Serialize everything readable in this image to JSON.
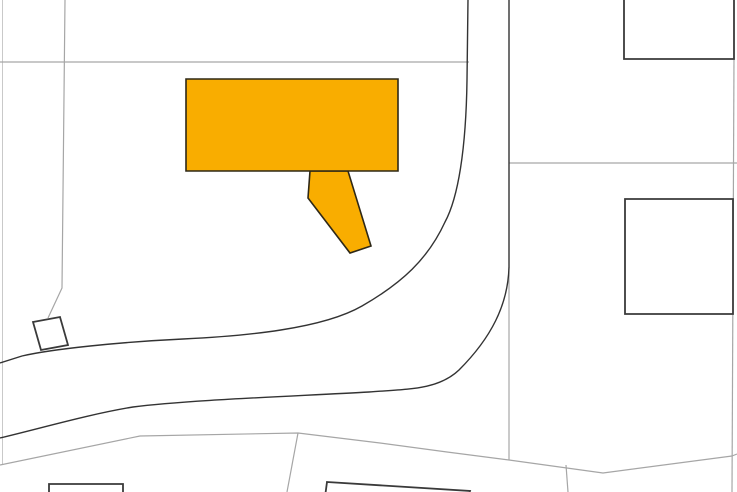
{
  "map": {
    "canvas": {
      "width": 737,
      "height": 492,
      "background": "#ffffff"
    },
    "colors": {
      "highlight_fill": "#F9AD00",
      "highlight_stroke": "#2E2817",
      "building_fill": "#FFFFFF",
      "building_stroke": "#3A3A3A",
      "road_stroke": "#333333",
      "parcel_stroke": "#A6A6A6",
      "parcel_stroke_faint": "#C9C9C9"
    },
    "parcel_lines": [
      {
        "id": "parcel-boundary-left-edge",
        "path": "M2.5,0 L2.5,465",
        "faint": true
      },
      {
        "id": "parcel-boundary-west",
        "path": "M65,0 L62,288 L48,318"
      },
      {
        "id": "parcel-boundary-north",
        "path": "M0,62 L469,62"
      },
      {
        "id": "parcel-boundary-east-cross",
        "path": "M509,163 L737,163"
      },
      {
        "id": "parcel-boundary-east",
        "path": "M734,57 L732,492"
      },
      {
        "id": "parcel-boundary-road-segment",
        "path": "M509,267 L509,460"
      },
      {
        "id": "parcel-boundary-south",
        "path": "M0,465 L140,436 L298,433 L380,443 L447,452 L509,460 L603,473 L732,456 L737,454"
      },
      {
        "id": "parcel-branch-south-west",
        "path": "M298,433 L287,492"
      },
      {
        "id": "parcel-branch-south-mid",
        "path": "M566,465 L568,492"
      }
    ],
    "roads": [
      {
        "id": "road-edge-west",
        "path": "M468,-1 L467,80 C466,150 458,198 445,222 C428,259 402,283 362,306 C322,329 245,336 183,339 C120,342 52,349 22,356 L0,363"
      },
      {
        "id": "road-edge-east",
        "path": "M509,-1 L509,267 C508,305 491,338 459,370 C438,390 408,389 369,392 C300,396 185,400 133,407 C90,414 42,428 0,438"
      }
    ],
    "buildings": [
      {
        "id": "building-northeast",
        "path": "M624,-4 L734,-4 L734,59 L624,59 Z"
      },
      {
        "id": "building-east",
        "path": "M625,199 L733,199 L733,314 L625,314 Z"
      },
      {
        "id": "building-shed-west",
        "path": "M33,322 L60,317 L68,345 L41,350 Z"
      },
      {
        "id": "building-south-west",
        "path": "M49,484 L123,484 L123,497 L49,497 Z"
      },
      {
        "id": "building-south",
        "path": "M327,482 L470,491 L468,497 L325,497 Z"
      }
    ],
    "highlighted_building": {
      "id": "selected-building",
      "annex_path": "M310,171 L308,198 L350,253 L371,246 L348,171 Z",
      "main_path": "M186,79 L398,79 L398,171 L186,171 Z"
    }
  }
}
